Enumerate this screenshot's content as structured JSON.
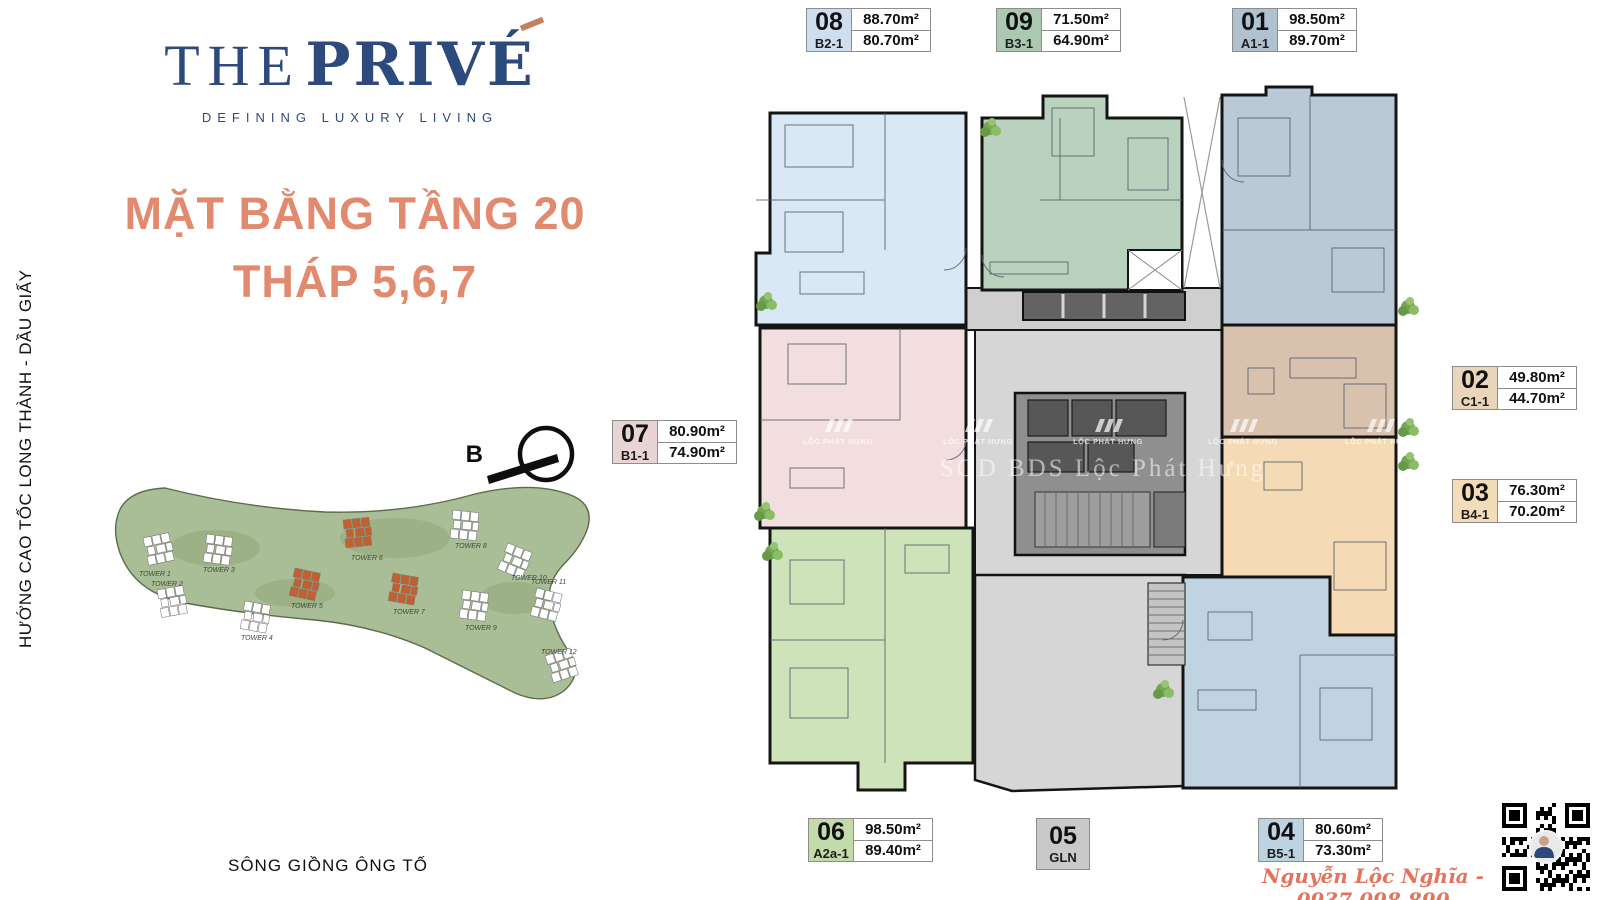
{
  "logo": {
    "the": "THE",
    "prive": "PRIV",
    "e_letter": "É",
    "tagline": "DEFINING LUXURY LIVING"
  },
  "title": {
    "line1": "MẶT BẰNG TẦNG 20",
    "line2": "THÁP 5,6,7"
  },
  "context": {
    "highway": "HƯỚNG CAO TỐC LONG THÀNH - DẦU GIẤY",
    "river": "SÔNG GIỒNG ÔNG TỐ",
    "compass": "B"
  },
  "site_map": {
    "towers": [
      {
        "name": "TOWER 1",
        "highlight": false
      },
      {
        "name": "TOWER 2",
        "highlight": false
      },
      {
        "name": "TOWER 3",
        "highlight": false
      },
      {
        "name": "TOWER 4",
        "highlight": false
      },
      {
        "name": "TOWER 5",
        "highlight": true
      },
      {
        "name": "TOWER 6",
        "highlight": true
      },
      {
        "name": "TOWER 7",
        "highlight": true
      },
      {
        "name": "TOWER 8",
        "highlight": false
      },
      {
        "name": "TOWER 9",
        "highlight": false
      },
      {
        "name": "TOWER 10",
        "highlight": false
      },
      {
        "name": "TOWER 11",
        "highlight": false
      },
      {
        "name": "TOWER 12",
        "highlight": false
      }
    ]
  },
  "units": {
    "u01": {
      "no": "01",
      "code": "A1-1",
      "area1": "98.50m²",
      "area2": "89.70m²",
      "label_bg": "#b0c1d0",
      "fill": "#bac9d6"
    },
    "u02": {
      "no": "02",
      "code": "C1-1",
      "area1": "49.80m²",
      "area2": "44.70m²",
      "label_bg": "#e8d5ba",
      "fill": "#d8c2ad"
    },
    "u03": {
      "no": "03",
      "code": "B4-1",
      "area1": "76.30m²",
      "area2": "70.20m²",
      "label_bg": "#f4dcb8",
      "fill": "#f5dab6"
    },
    "u04": {
      "no": "04",
      "code": "B5-1",
      "area1": "80.60m²",
      "area2": "73.30m²",
      "label_bg": "#bdd3e2",
      "fill": "#bfd4e0"
    },
    "u05": {
      "no": "05",
      "code": "GLN",
      "label_bg": "#c9c9c9"
    },
    "u06": {
      "no": "06",
      "code": "A2a-1",
      "area1": "98.50m²",
      "area2": "89.40m²",
      "label_bg": "#c3dba8",
      "fill": "#cfe3bb"
    },
    "u07": {
      "no": "07",
      "code": "B1-1",
      "area1": "80.90m²",
      "area2": "74.90m²",
      "label_bg": "#e8d4d4",
      "fill": "#f2dede"
    },
    "u08": {
      "no": "08",
      "code": "B2-1",
      "area1": "88.70m²",
      "area2": "80.70m²",
      "label_bg": "#cfdeee",
      "fill": "#d9e8f4"
    },
    "u09": {
      "no": "09",
      "code": "B3-1",
      "area1": "71.50m²",
      "area2": "64.90m²",
      "label_bg": "#abc9b0",
      "fill": "#b9d2bd"
    }
  },
  "watermark": {
    "brand": "LỘC PHÁT HƯNG",
    "center": "SGD BDS Lộc Phát Hưng"
  },
  "footer": {
    "agent": "Nguyễn Lộc Nghĩa - 0937.098.890"
  },
  "colors": {
    "navy": "#2c4a7c",
    "coral": "#e18a70",
    "copper": "#c5805f",
    "footer": "#e0745c",
    "tower_white": "#ffffff",
    "tower_orange": "#c2602e",
    "land": "#a9bd96"
  }
}
